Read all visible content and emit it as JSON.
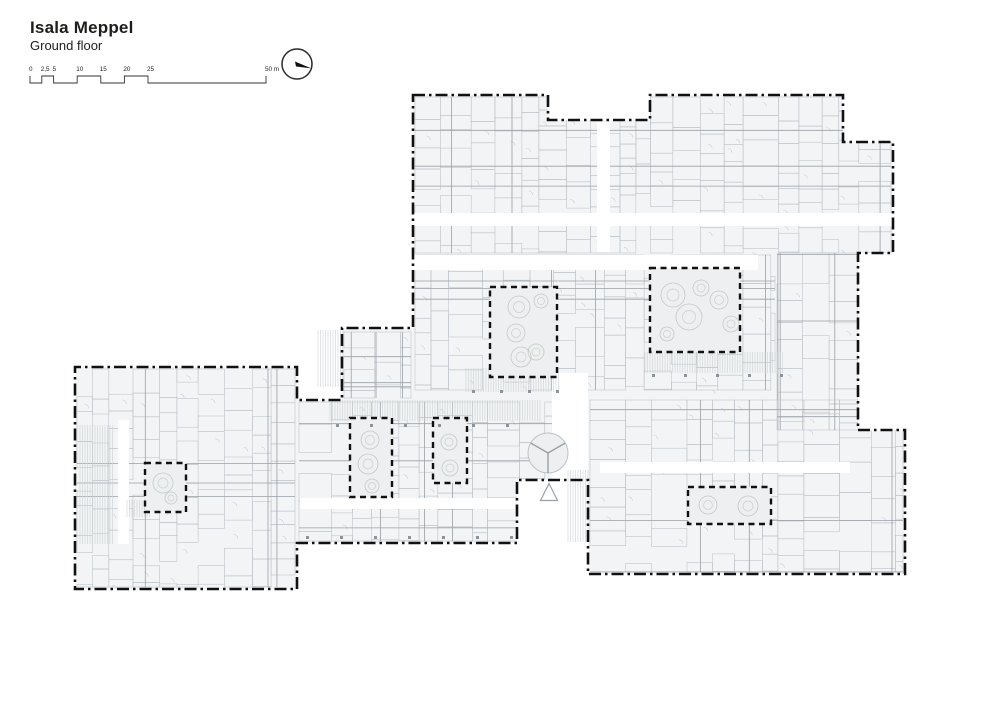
{
  "header": {
    "title": "Isala Meppel",
    "subtitle": "Ground floor"
  },
  "scale_bar": {
    "x0": 30,
    "x1": 266,
    "max_m": 50,
    "y_low": 83,
    "y_high": 76,
    "label_y": 71,
    "marks": [
      {
        "m": 0,
        "label": "0"
      },
      {
        "m": 2.5,
        "label": "2,5"
      },
      {
        "m": 5,
        "label": "5"
      },
      {
        "m": 10,
        "label": "10"
      },
      {
        "m": 15,
        "label": "15"
      },
      {
        "m": 20,
        "label": "20"
      },
      {
        "m": 25,
        "label": "25"
      },
      {
        "m": 50,
        "label": "50 m"
      }
    ]
  },
  "north_arrow": {
    "cx": 297,
    "cy": 64,
    "r": 15,
    "needle_angle_deg": 17
  },
  "colors": {
    "outline": "#111111",
    "plan_fill": "#f3f4f5",
    "courtyard_fill": "#edeff0",
    "room_stroke": "#bcc2c8",
    "wall_stroke": "#9aa0a6",
    "door_stroke": "#c6cbd0",
    "hatch_stroke": "#cbd0d4",
    "tree_stroke": "#9fae9f",
    "column_fill": "#8d939a",
    "text": "#1d1d1b"
  },
  "plan": {
    "outline": [
      [
        413,
        95
      ],
      [
        548,
        95
      ],
      [
        548,
        120
      ],
      [
        650,
        120
      ],
      [
        650,
        95
      ],
      [
        843,
        95
      ],
      [
        843,
        142
      ],
      [
        893,
        142
      ],
      [
        893,
        253
      ],
      [
        858,
        253
      ],
      [
        858,
        430
      ],
      [
        905,
        430
      ],
      [
        905,
        574
      ],
      [
        588,
        574
      ],
      [
        588,
        480
      ],
      [
        517,
        480
      ],
      [
        517,
        543
      ],
      [
        297,
        543
      ],
      [
        297,
        589
      ],
      [
        75,
        589
      ],
      [
        75,
        367
      ],
      [
        297,
        367
      ],
      [
        297,
        400
      ],
      [
        342,
        400
      ],
      [
        342,
        328
      ],
      [
        413,
        328
      ]
    ],
    "texture_blocks": [
      {
        "x": 415,
        "y": 97,
        "w": 476,
        "h": 156,
        "seed": 11
      },
      {
        "x": 415,
        "y": 255,
        "w": 360,
        "h": 135,
        "seed": 23
      },
      {
        "x": 777,
        "y": 253,
        "w": 81,
        "h": 177,
        "seed": 37
      },
      {
        "x": 299,
        "y": 402,
        "w": 287,
        "h": 139,
        "seed": 41
      },
      {
        "x": 77,
        "y": 369,
        "w": 218,
        "h": 218,
        "seed": 53
      },
      {
        "x": 590,
        "y": 400,
        "w": 313,
        "h": 172,
        "seed": 67
      },
      {
        "x": 344,
        "y": 332,
        "w": 67,
        "h": 66,
        "seed": 71
      }
    ],
    "whites": [
      [
        413,
        213,
        480,
        13
      ],
      [
        413,
        255,
        345,
        15
      ],
      [
        597,
        122,
        13,
        130
      ],
      [
        300,
        498,
        215,
        11
      ],
      [
        118,
        420,
        11,
        124
      ],
      [
        600,
        462,
        250,
        11
      ],
      [
        552,
        373,
        36,
        106
      ]
    ],
    "hatches": [
      [
        318,
        330,
        27,
        57
      ],
      [
        466,
        368,
        93,
        24
      ],
      [
        645,
        352,
        138,
        21
      ],
      [
        330,
        400,
        211,
        21
      ],
      [
        80,
        425,
        34,
        119
      ],
      [
        568,
        470,
        21,
        72
      ],
      [
        127,
        500,
        23,
        17
      ]
    ],
    "inner_lines": [
      [
        652,
        332,
        738,
        332
      ],
      [
        652,
        337,
        738,
        337
      ]
    ],
    "courtyards": [
      {
        "x": 490,
        "y": 287,
        "w": 67,
        "h": 90,
        "trees": [
          [
            519,
            307,
            11
          ],
          [
            541,
            301,
            7
          ],
          [
            516,
            333,
            9
          ],
          [
            536,
            352,
            8
          ],
          [
            521,
            357,
            10
          ]
        ]
      },
      {
        "x": 650,
        "y": 268,
        "w": 90,
        "h": 84,
        "trees": [
          [
            673,
            295,
            12
          ],
          [
            701,
            288,
            8
          ],
          [
            689,
            317,
            13
          ],
          [
            719,
            300,
            9
          ],
          [
            731,
            324,
            8
          ],
          [
            667,
            334,
            7
          ]
        ]
      },
      {
        "x": 145,
        "y": 463,
        "w": 41,
        "h": 49,
        "trees": [
          [
            163,
            483,
            10
          ],
          [
            171,
            498,
            6
          ]
        ]
      },
      {
        "x": 350,
        "y": 418,
        "w": 42,
        "h": 79,
        "trees": [
          [
            370,
            440,
            9
          ],
          [
            368,
            464,
            10
          ],
          [
            372,
            486,
            7
          ]
        ]
      },
      {
        "x": 433,
        "y": 418,
        "w": 34,
        "h": 65,
        "trees": [
          [
            449,
            442,
            8
          ],
          [
            450,
            468,
            8
          ]
        ]
      },
      {
        "x": 688,
        "y": 487,
        "w": 83,
        "h": 37,
        "trees": [
          [
            708,
            505,
            9
          ],
          [
            748,
            506,
            10
          ]
        ]
      }
    ],
    "column_rows": [
      {
        "y": 390,
        "x0": 472,
        "x1": 556,
        "step": 28
      },
      {
        "y": 424,
        "x0": 336,
        "x1": 538,
        "step": 34
      },
      {
        "y": 374,
        "x0": 652,
        "x1": 780,
        "step": 32
      },
      {
        "y": 536,
        "x0": 306,
        "x1": 512,
        "step": 34
      }
    ],
    "symbols": {
      "revolving_door": {
        "cx": 548,
        "cy": 453,
        "r": 20
      },
      "entrance_triangle": {
        "cx": 549,
        "cy": 492,
        "s": 17
      }
    }
  }
}
